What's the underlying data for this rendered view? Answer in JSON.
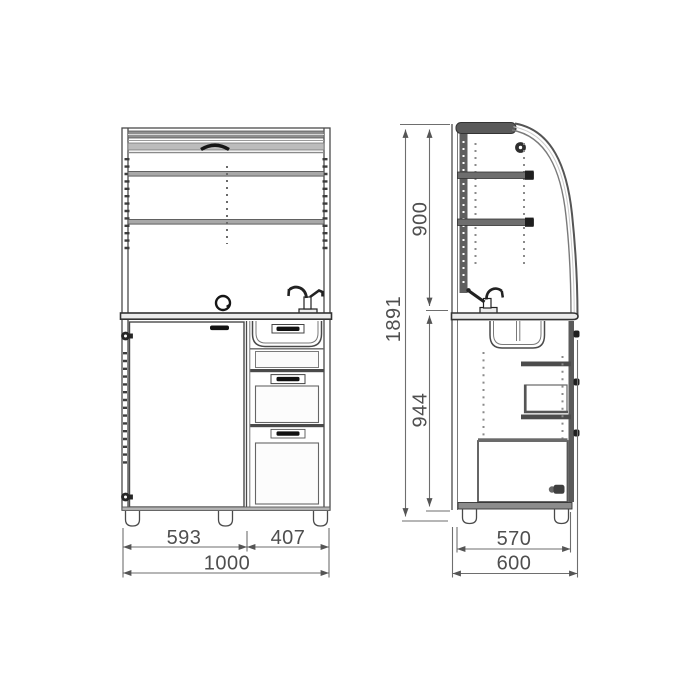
{
  "drawing": {
    "kind": "furniture-technical-drawing",
    "colors": {
      "line": "#4a4a4a",
      "dark_fill": "#555555",
      "light_fill": "#b9b9b9",
      "dimension_line": "#6e6e6e",
      "dimension_text": "#4f4f4f",
      "background": "#ffffff"
    }
  },
  "dimensions": {
    "front": {
      "door_width": "593",
      "drawers_width": "407",
      "overall_width": "1000"
    },
    "side": {
      "upper_height": "900",
      "overall_height": "1891",
      "lower_height": "944",
      "carcass_depth": "570",
      "overall_depth": "600"
    }
  }
}
